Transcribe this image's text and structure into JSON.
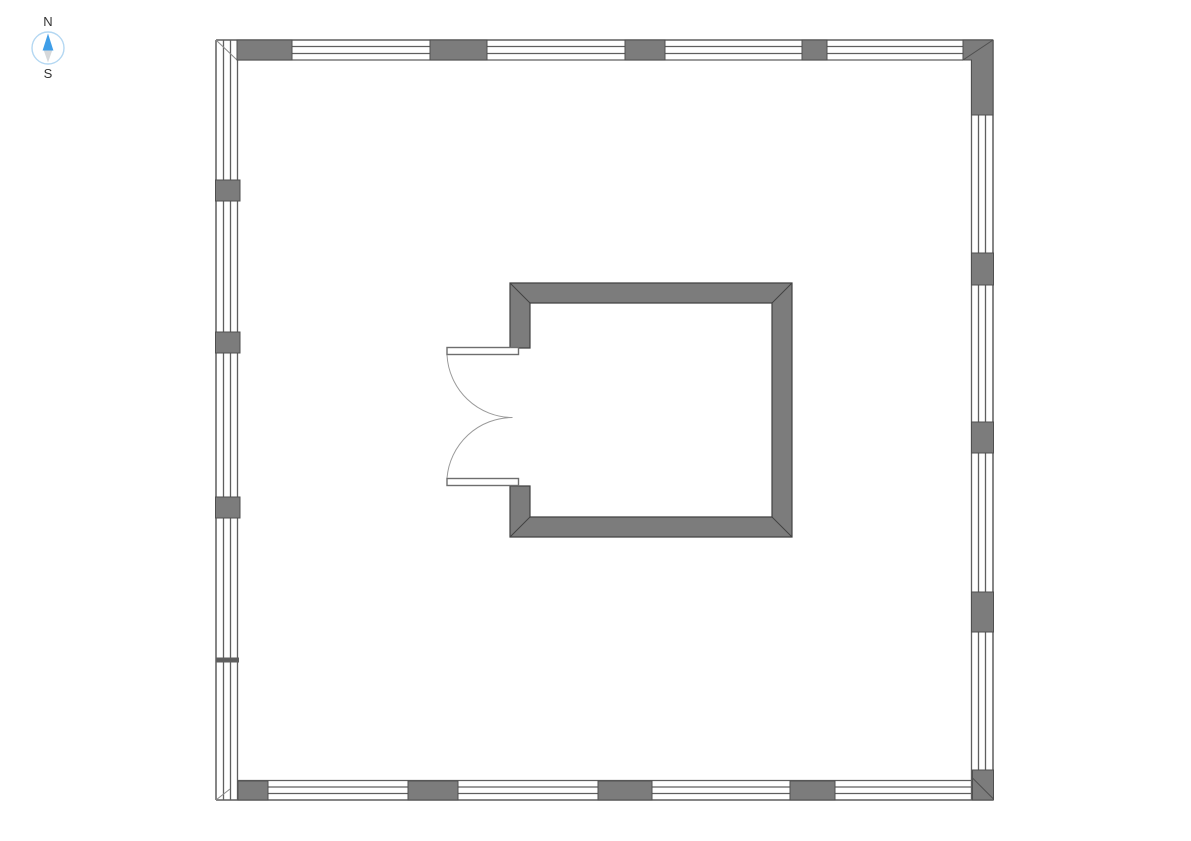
{
  "compass": {
    "north_label": "N",
    "south_label": "S",
    "icon": "compass-rose-icon"
  },
  "colors": {
    "background": "#ffffff",
    "window_line": "#5f5f5f",
    "wall_fill": "#7c7c7c",
    "wall_outline": "#4f4f4f",
    "room_outline": "#424242",
    "door_arc": "#9a9a9a",
    "door_leaf_outline": "#6e6e6e",
    "compass_north": "#3f9ee8",
    "compass_south": "#d6d8da",
    "compass_ring": "#b3d7f2",
    "label_text": "#333333"
  }
}
